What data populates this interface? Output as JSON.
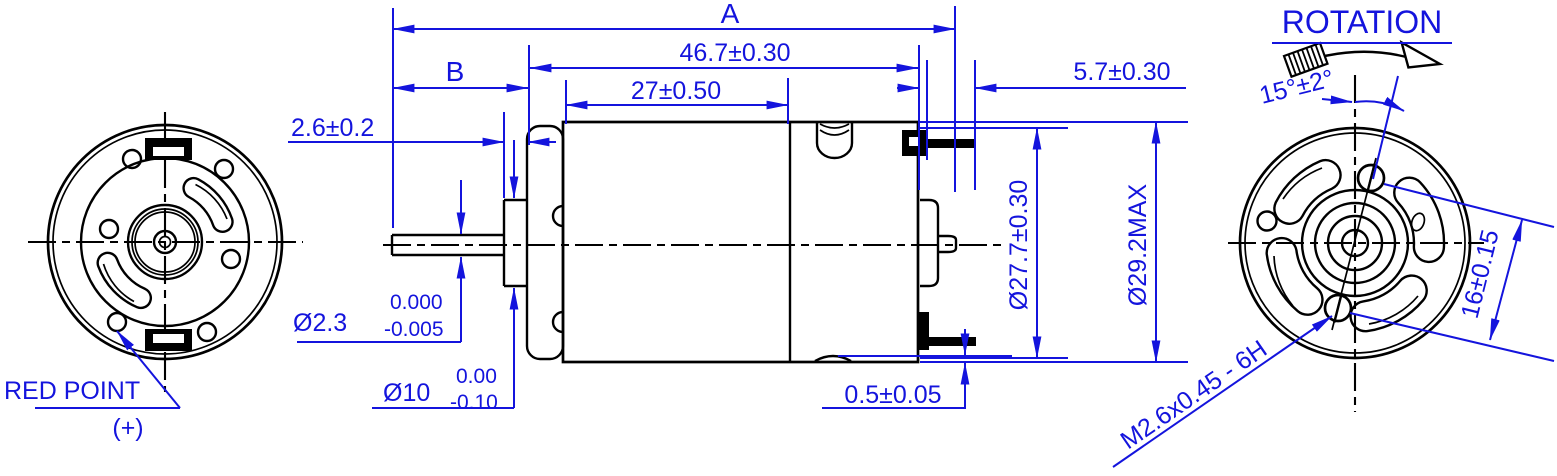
{
  "drawing": {
    "colors": {
      "dimension_blue": "#1414dd",
      "line_black": "#000000",
      "background": "#ffffff"
    },
    "front_view": {
      "red_point_label": "RED POINT",
      "polarity_label": "(+)"
    },
    "side_view": {
      "overall_length_label": "A",
      "shaft_extension_label": "B",
      "case_length": "46.7±0.30",
      "can_length": "27±0.50",
      "terminal_length": "5.7±0.30",
      "bushing_protrusion": "2.6±0.2",
      "shaft_diameter": "Ø2.3",
      "shaft_tol_upper": "0.000",
      "shaft_tol_lower": "-0.005",
      "bushing_diameter": "Ø10",
      "bushing_tol_upper": "0.00",
      "bushing_tol_lower": "-0.10",
      "endcap_diameter": "Ø27.7±0.30",
      "case_diameter": "Ø29.2MAX",
      "case_indent": "0.5±0.05"
    },
    "rear_view": {
      "rotation_label": "ROTATION",
      "rotation_angle": "15°±2°",
      "screw_spacing": "16±0.15",
      "thread_spec": "M2.6x0.45 - 6H"
    }
  }
}
